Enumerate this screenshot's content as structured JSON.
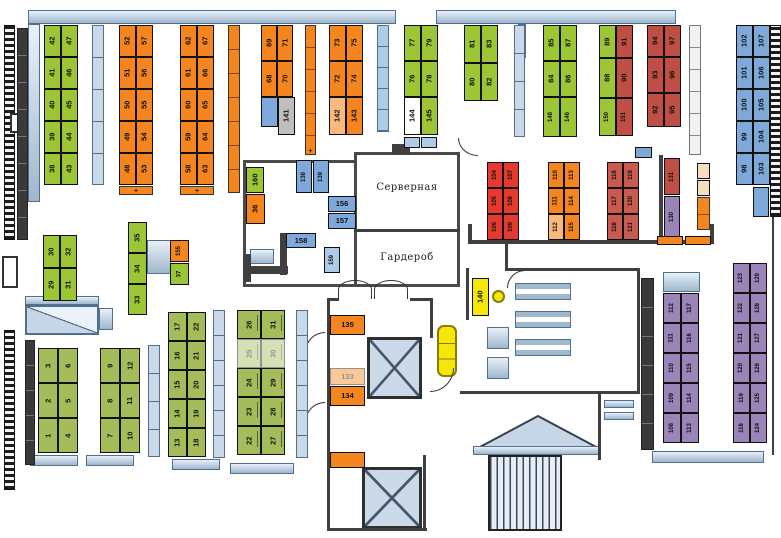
{
  "rooms": {
    "server": "Серверная",
    "wardrobe": "Гардероб"
  },
  "colors": {
    "g": "#9CC636",
    "g2": "#A4BC5A",
    "o": "#F5861F",
    "ol": "#F8B97E",
    "r1": "#E63A2E",
    "r2": "#BF4F44",
    "r2l": "#C95A50",
    "b": "#7FA9DA",
    "bl": "#AECBE8",
    "p": "#9B85B8",
    "gray": "#BFBFBF",
    "y": "#F6E70B",
    "peach": "#F6DCC0"
  },
  "desk_groups": [
    {
      "id": "top-38",
      "x": 44,
      "y": 25,
      "cw": 17,
      "rh": 32,
      "c": "g",
      "rows": [
        [
          "42",
          "47"
        ],
        [
          "41",
          "46"
        ],
        [
          "40",
          "45"
        ],
        [
          "39",
          "44"
        ],
        [
          "38",
          "43"
        ]
      ]
    },
    {
      "id": "top-48",
      "x": 119,
      "y": 25,
      "cw": 17,
      "rh": 32,
      "c": "o",
      "rows": [
        [
          "52",
          "57"
        ],
        [
          "51",
          "56"
        ],
        [
          "50",
          "55"
        ],
        [
          "49",
          "54"
        ],
        [
          "48",
          "53"
        ]
      ]
    },
    {
      "id": "top-58",
      "x": 180,
      "y": 25,
      "cw": 17,
      "rh": 32,
      "c": "o",
      "rows": [
        [
          "62",
          "67"
        ],
        [
          "61",
          "66"
        ],
        [
          "60",
          "65"
        ],
        [
          "59",
          "64"
        ],
        [
          "58",
          "63"
        ]
      ]
    },
    {
      "id": "top-68",
      "x": 261,
      "y": 25,
      "cw": 16,
      "rh": 36,
      "c": "o",
      "rows": [
        [
          "69",
          "71"
        ],
        [
          "68",
          "70"
        ]
      ]
    },
    {
      "id": "top-72",
      "x": 329,
      "y": 25,
      "cw": 17,
      "rh": [
        36,
        36,
        38
      ],
      "c": "o",
      "rows": [
        [
          "73",
          "75"
        ],
        [
          "72",
          "74"
        ],
        [
          {
            "t": "142",
            "c": "ol"
          },
          "143"
        ]
      ]
    },
    {
      "id": "top-76",
      "x": 404,
      "y": 25,
      "cw": 17,
      "rh": [
        36,
        36,
        38
      ],
      "c": "g",
      "rows": [
        [
          "77",
          "79"
        ],
        [
          "76",
          "78"
        ],
        [
          {
            "t": "144",
            "fill": "#ffffff"
          },
          "145"
        ]
      ]
    },
    {
      "id": "top-80",
      "x": 464,
      "y": 25,
      "cw": 17,
      "rh": 38,
      "c": "g",
      "rows": [
        [
          "81",
          "83"
        ],
        [
          "80",
          "82"
        ]
      ]
    },
    {
      "id": "top-84",
      "x": 543,
      "y": 25,
      "cw": 17,
      "rh": [
        36,
        36,
        40
      ],
      "c": "g",
      "rows": [
        [
          "85",
          "87"
        ],
        [
          "84",
          "86"
        ],
        [
          {
            "t": "148",
            "small": 1
          },
          {
            "t": "146",
            "small": 1
          }
        ]
      ]
    },
    {
      "id": "top-88",
      "x": 599,
      "y": 25,
      "cw": 17,
      "rh": [
        33,
        40,
        38
      ],
      "c": "g",
      "rows": [
        [
          {
            "t": "89"
          },
          {
            "t": "91",
            "c": "r2"
          }
        ],
        [
          {
            "t": "88"
          },
          {
            "t": "90",
            "c": "r2"
          }
        ],
        [
          {
            "t": "150",
            "small": 1
          },
          {
            "t": "151",
            "c": "r2",
            "small": 1
          }
        ]
      ]
    },
    {
      "id": "top-92",
      "x": 647,
      "y": 25,
      "cw": 17,
      "rh": [
        32,
        36,
        34
      ],
      "c": "r2",
      "rows": [
        [
          "94",
          "97"
        ],
        [
          "93",
          "96"
        ],
        [
          "92",
          "95"
        ]
      ]
    },
    {
      "id": "top-98",
      "x": 736,
      "y": 25,
      "cw": 17,
      "rh": 32,
      "c": "b",
      "rows": [
        [
          "102",
          "107"
        ],
        [
          "101",
          "106"
        ],
        [
          "100",
          "105"
        ],
        [
          "99",
          "104"
        ],
        [
          "98",
          "103"
        ]
      ]
    },
    {
      "id": "mid-29",
      "x": 43,
      "y": 235,
      "cw": 17,
      "rh": 33,
      "c": "g",
      "rows": [
        [
          "30",
          "32"
        ],
        [
          "29",
          "31"
        ]
      ]
    },
    {
      "id": "mid-33",
      "x": 128,
      "y": 222,
      "cw": 19,
      "rh": 31,
      "c": "g",
      "rows": [
        [
          "35"
        ],
        [
          "34"
        ],
        [
          "33"
        ]
      ]
    },
    {
      "id": "mid-104",
      "x": 487,
      "y": 162,
      "cw": 16,
      "rh": 26,
      "c": "r1",
      "small": 1,
      "rows": [
        [
          "104",
          "107"
        ],
        [
          "105",
          "108"
        ],
        [
          "106",
          "109"
        ]
      ]
    },
    {
      "id": "mid-110",
      "x": 548,
      "y": 162,
      "cw": 16,
      "rh": 26,
      "c": "o",
      "small": 1,
      "rows": [
        [
          "110",
          "113"
        ],
        [
          "111",
          "114"
        ],
        [
          {
            "t": "112",
            "c": "ol"
          },
          "115"
        ]
      ]
    },
    {
      "id": "mid-116",
      "x": 607,
      "y": 162,
      "cw": 16,
      "rh": 26,
      "c": "r2l",
      "small": 1,
      "rows": [
        [
          "116",
          "119"
        ],
        [
          "117",
          "120"
        ],
        [
          "118",
          "121"
        ]
      ]
    },
    {
      "id": "br-108",
      "x": 663,
      "y": 293,
      "cw": 18,
      "rh": 30,
      "c": "p",
      "small": 1,
      "rows": [
        [
          "112",
          "117"
        ],
        [
          "111",
          "116"
        ],
        [
          "110",
          "115"
        ],
        [
          "109",
          "114"
        ],
        [
          "108",
          "113"
        ]
      ]
    },
    {
      "id": "br-118",
      "x": 733,
      "y": 263,
      "cw": 17,
      "rh": 30,
      "c": "p",
      "small": 1,
      "rows": [
        [
          "123",
          "129"
        ],
        [
          "122",
          "128"
        ],
        [
          "121",
          "127"
        ],
        [
          "120",
          "126"
        ],
        [
          "119",
          "125"
        ],
        [
          "118",
          "124"
        ]
      ]
    },
    {
      "id": "bl-1",
      "x": 38,
      "y": 348,
      "cw": 20,
      "rh": 35,
      "c": "g2",
      "rows": [
        [
          "3",
          "6"
        ],
        [
          "2",
          "5"
        ],
        [
          "1",
          "4"
        ]
      ]
    },
    {
      "id": "bl-7",
      "x": 100,
      "y": 348,
      "cw": 20,
      "rh": 35,
      "c": "g2",
      "rows": [
        [
          "9",
          "12"
        ],
        [
          "8",
          "11"
        ],
        [
          "7",
          "10"
        ]
      ]
    },
    {
      "id": "bl-13",
      "x": 168,
      "y": 312,
      "cw": 19,
      "rh": 29,
      "c": "g2",
      "rows": [
        [
          "17",
          "22"
        ],
        [
          "16",
          "21"
        ],
        [
          "15",
          "20"
        ],
        [
          "14",
          "19"
        ],
        [
          "13",
          "18"
        ]
      ]
    },
    {
      "id": "bl-22",
      "x": 237,
      "y": 310,
      "cw": 24,
      "rh": 29,
      "c": "g2",
      "tag": 1,
      "rows": [
        [
          "26",
          "31"
        ],
        [
          {
            "t": "25",
            "faded": 1
          },
          {
            "t": "30",
            "faded": 1
          }
        ],
        [
          "24",
          "29"
        ],
        [
          "23",
          "28"
        ],
        [
          "22",
          "27"
        ]
      ]
    }
  ],
  "single_cells": [
    {
      "t": "141",
      "x": 278,
      "y": 97,
      "w": 17,
      "h": 38,
      "c": "gray",
      "v": 1
    },
    {
      "x": 261,
      "y": 97,
      "w": 17,
      "h": 30,
      "c": "b"
    },
    {
      "t": "160",
      "x": 246,
      "y": 167,
      "w": 18,
      "h": 26,
      "c": "g",
      "v": 1
    },
    {
      "t": "36",
      "x": 246,
      "y": 194,
      "w": 19,
      "h": 30,
      "c": "o",
      "v": 1
    },
    {
      "t": "155",
      "x": 170,
      "y": 240,
      "w": 19,
      "h": 22,
      "c": "o",
      "v": 1,
      "small": 1
    },
    {
      "t": "37",
      "x": 170,
      "y": 263,
      "w": 19,
      "h": 22,
      "c": "g",
      "v": 1,
      "small": 1
    },
    {
      "t": "138",
      "x": 296,
      "y": 160,
      "w": 16,
      "h": 33,
      "c": "b",
      "v": 1,
      "small": 1
    },
    {
      "t": "139",
      "x": 313,
      "y": 160,
      "w": 16,
      "h": 33,
      "c": "b",
      "v": 1,
      "small": 1
    },
    {
      "t": "156",
      "x": 328,
      "y": 196,
      "w": 28,
      "h": 16,
      "c": "b"
    },
    {
      "t": "157",
      "x": 328,
      "y": 213,
      "w": 28,
      "h": 16,
      "c": "b"
    },
    {
      "t": "158",
      "x": 286,
      "y": 233,
      "w": 30,
      "h": 15,
      "c": "b"
    },
    {
      "t": "159",
      "x": 324,
      "y": 247,
      "w": 16,
      "h": 26,
      "c": "bl",
      "v": 1,
      "small": 1
    },
    {
      "t": "131",
      "x": 664,
      "y": 158,
      "w": 16,
      "h": 37,
      "c": "r2",
      "v": 1,
      "small": 1
    },
    {
      "t": "130",
      "x": 664,
      "y": 196,
      "w": 16,
      "h": 42,
      "c": "p",
      "v": 1,
      "small": 1
    },
    {
      "t": "135",
      "x": 330,
      "y": 315,
      "w": 35,
      "h": 20,
      "c": "o"
    },
    {
      "t": "133",
      "x": 330,
      "y": 368,
      "w": 35,
      "h": 17,
      "c": "o",
      "faded": 1
    },
    {
      "t": "134",
      "x": 330,
      "y": 386,
      "w": 35,
      "h": 20,
      "c": "o"
    },
    {
      "x": 330,
      "y": 452,
      "w": 35,
      "h": 16,
      "c": "o"
    },
    {
      "t": "140",
      "x": 472,
      "y": 278,
      "w": 17,
      "h": 38,
      "c": "y",
      "v": 1
    },
    {
      "x": 697,
      "y": 163,
      "w": 13,
      "h": 16,
      "c": "peach"
    },
    {
      "x": 697,
      "y": 180,
      "w": 13,
      "h": 16,
      "c": "peach"
    },
    {
      "x": 753,
      "y": 187,
      "w": 16,
      "h": 30,
      "c": "b"
    },
    {
      "x": 404,
      "y": 137,
      "w": 16,
      "h": 11,
      "c": "bl"
    },
    {
      "x": 421,
      "y": 137,
      "w": 16,
      "h": 11,
      "c": "bl"
    },
    {
      "x": 635,
      "y": 147,
      "w": 17,
      "h": 11,
      "c": "b"
    },
    {
      "x": 657,
      "y": 236,
      "w": 26,
      "h": 9,
      "c": "o"
    },
    {
      "x": 685,
      "y": 236,
      "w": 26,
      "h": 9,
      "c": "o"
    }
  ],
  "shelves": [
    {
      "x": 92,
      "y": 25,
      "w": 12,
      "h": 160,
      "segs": 5,
      "c": "steel"
    },
    {
      "x": 228,
      "y": 25,
      "w": 12,
      "h": 168,
      "segs": 7,
      "c": "o"
    },
    {
      "x": 305,
      "y": 25,
      "w": 11,
      "h": 130,
      "segs": 6,
      "c": "o",
      "plus": "+"
    },
    {
      "x": 377,
      "y": 25,
      "w": 12,
      "h": 107,
      "segs": 5,
      "c": "bl"
    },
    {
      "x": 514,
      "y": 25,
      "w": 11,
      "h": 112,
      "segs": 4,
      "c": "steel"
    },
    {
      "x": 689,
      "y": 25,
      "w": 12,
      "h": 130,
      "segs": 6,
      "c": "wht"
    },
    {
      "x": 697,
      "y": 197,
      "w": 13,
      "h": 33,
      "segs": 2,
      "c": "o"
    },
    {
      "x": 148,
      "y": 345,
      "w": 12,
      "h": 112,
      "segs": 4,
      "c": "steel"
    },
    {
      "x": 213,
      "y": 310,
      "w": 12,
      "h": 148,
      "segs": 6,
      "c": "steel"
    },
    {
      "x": 296,
      "y": 310,
      "w": 12,
      "h": 148,
      "segs": 6,
      "c": "steel"
    },
    {
      "x": 17,
      "y": 28,
      "w": 11,
      "h": 212,
      "segs": 8,
      "c": "dark"
    },
    {
      "x": 25,
      "y": 340,
      "w": 10,
      "h": 125,
      "segs": 5,
      "c": "dark"
    },
    {
      "x": 641,
      "y": 278,
      "w": 13,
      "h": 172,
      "segs": 6,
      "c": "dark"
    },
    {
      "x": 119,
      "y": 186,
      "w": 34,
      "h": 9,
      "segs": 1,
      "c": "o",
      "plus": "+"
    },
    {
      "x": 180,
      "y": 186,
      "w": 34,
      "h": 9,
      "segs": 1,
      "c": "o",
      "plus": "+"
    }
  ]
}
